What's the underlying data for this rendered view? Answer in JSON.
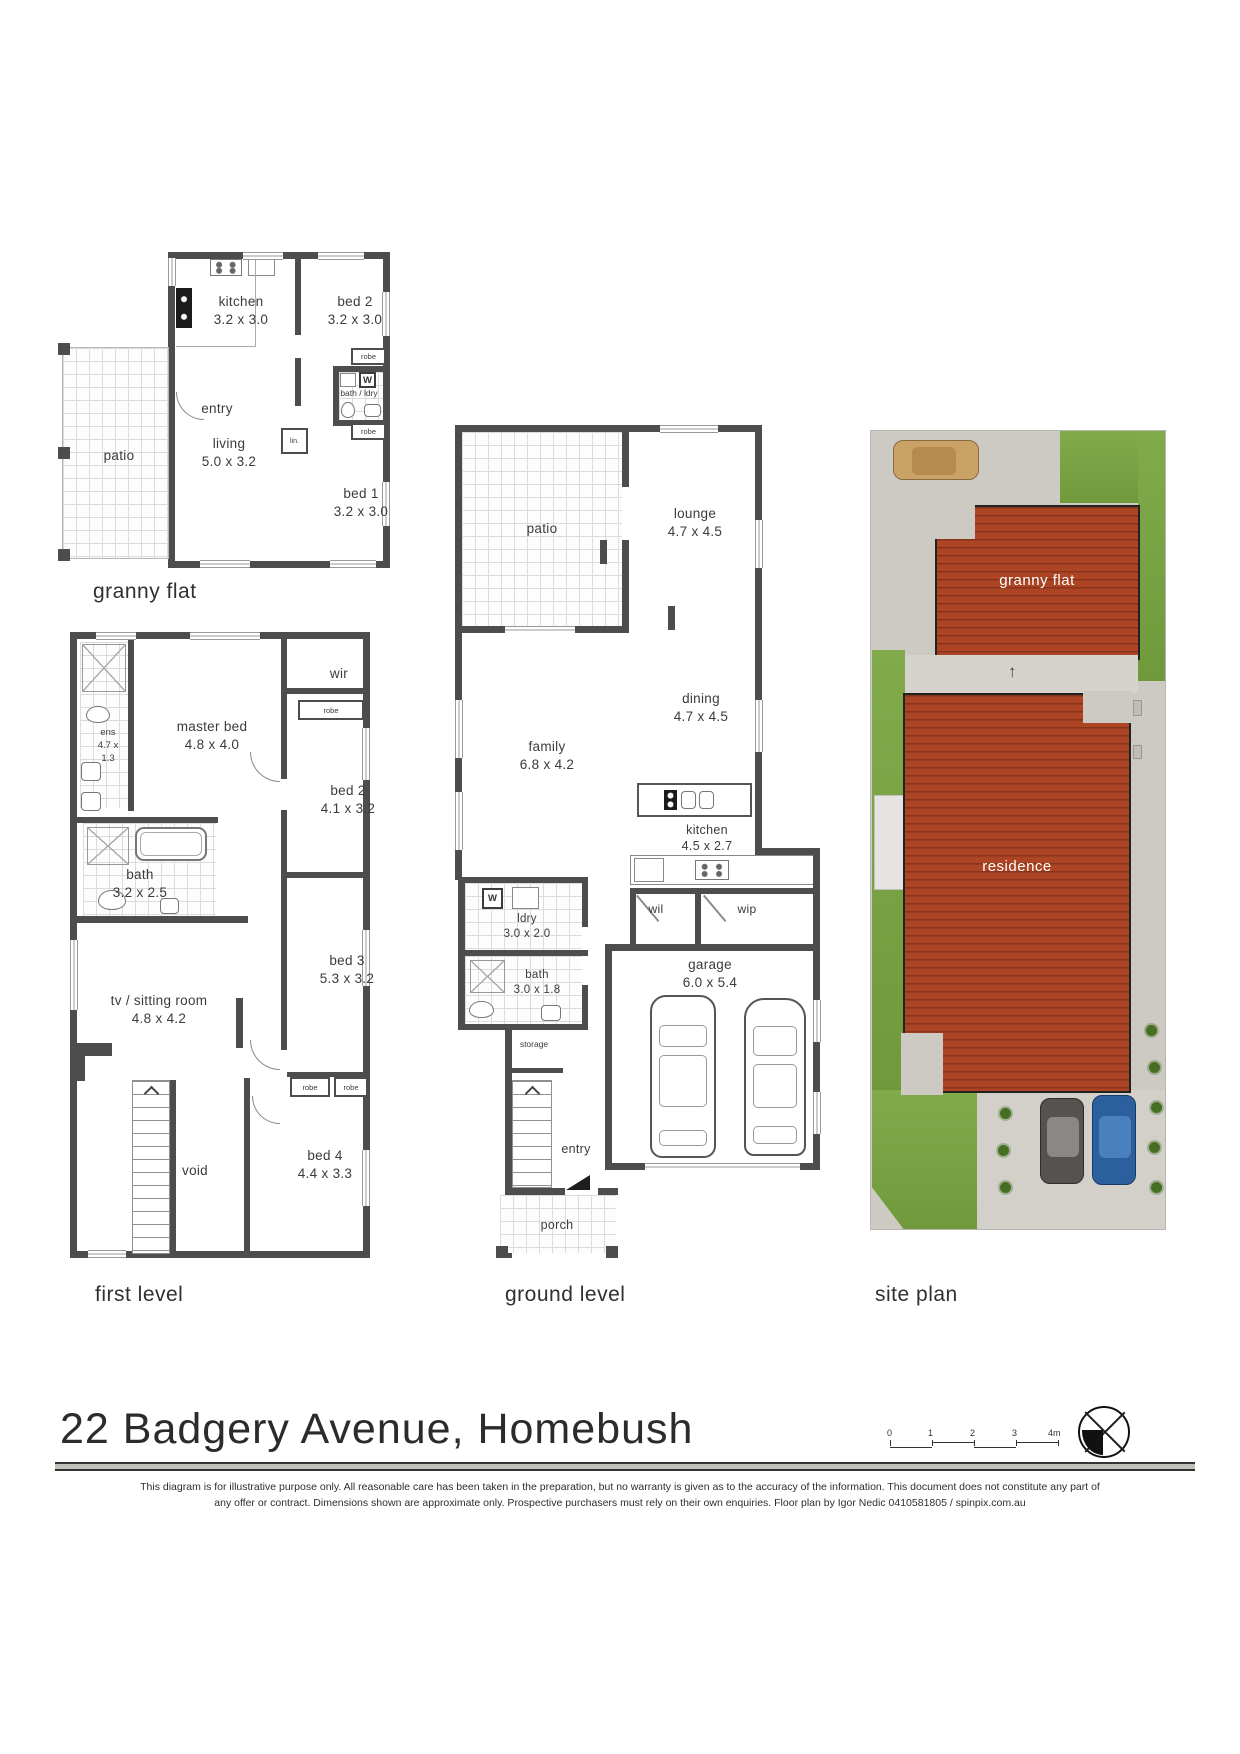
{
  "title": "22 Badgery Avenue, Homebush",
  "plan_labels": {
    "granny_flat": "granny flat",
    "first_level": "first level",
    "ground_level": "ground level",
    "site_plan": "site plan"
  },
  "granny_flat": {
    "kitchen": {
      "name": "kitchen",
      "dims": "3.2 x 3.0"
    },
    "bed2": {
      "name": "bed 2",
      "dims": "3.2 x 3.0"
    },
    "entry": {
      "name": "entry"
    },
    "living": {
      "name": "living",
      "dims": "5.0 x 3.2"
    },
    "bed1": {
      "name": "bed 1",
      "dims": "3.2 x 3.0"
    },
    "patio": {
      "name": "patio"
    },
    "bath_ldry": "bath / ldry",
    "robe_top": "robe",
    "robe_bottom": "robe",
    "lin": "lin.",
    "washer": "W"
  },
  "first_level": {
    "ens": {
      "line1": "ens",
      "line2": "4.7 x",
      "line3": "1.3"
    },
    "master_bed": {
      "name": "master bed",
      "dims": "4.8 x 4.0"
    },
    "wir": "wir",
    "robe_bed2": "robe",
    "bed2": {
      "name": "bed 2",
      "dims": "4.1 x 3.2"
    },
    "bath": {
      "name": "bath",
      "dims": "3.2 x 2.5"
    },
    "bed3": {
      "name": "bed 3",
      "dims": "5.3 x 3.2"
    },
    "tv_room": {
      "name": "tv / sitting room",
      "dims": "4.8 x 4.2"
    },
    "robe_a": "robe",
    "robe_b": "robe",
    "void": "void",
    "bed4": {
      "name": "bed 4",
      "dims": "4.4 x 3.3"
    }
  },
  "ground_level": {
    "patio": {
      "name": "patio"
    },
    "lounge": {
      "name": "lounge",
      "dims": "4.7 x 4.5"
    },
    "dining": {
      "name": "dining",
      "dims": "4.7 x 4.5"
    },
    "family": {
      "name": "family",
      "dims": "6.8 x 4.2"
    },
    "kitchen": {
      "name": "kitchen",
      "dims": "4.5 x 2.7"
    },
    "wil": "wil",
    "wip": "wip",
    "ldry": {
      "name": "ldry",
      "dims": "3.0 x 2.0"
    },
    "bath": {
      "name": "bath",
      "dims": "3.0 x 1.8"
    },
    "storage": "storage",
    "entry": "entry",
    "garage": {
      "name": "garage",
      "dims": "6.0 x 5.4"
    },
    "porch": {
      "name": "porch"
    },
    "washer": "W"
  },
  "site_plan": {
    "granny_flat": "granny flat",
    "residence": "residence"
  },
  "glyphs": {
    "up_arrow": "↑"
  },
  "scale_bar": {
    "ticks": [
      "0",
      "1",
      "2",
      "3",
      "4m"
    ]
  },
  "footer": {
    "disclaimer_line1": "This diagram is for illustrative purpose only. All reasonable care has been taken in the preparation, but no warranty is given as to the accuracy of the information. This document does not constitute any part of",
    "disclaimer_line2": "any offer or contract. Dimensions shown are approximate only. Prospective purchasers must rely on their own enquiries. Floor plan by Igor Nedic 0410581805 / spinpix.com.au"
  },
  "colors": {
    "wall": "#4d4d4d",
    "roof_red": "#ad4423",
    "lawn_green": "#79a640",
    "paving_grey": "#cdcac4",
    "car_blue": "#2c5f9e",
    "car_tan": "#c9a266"
  }
}
